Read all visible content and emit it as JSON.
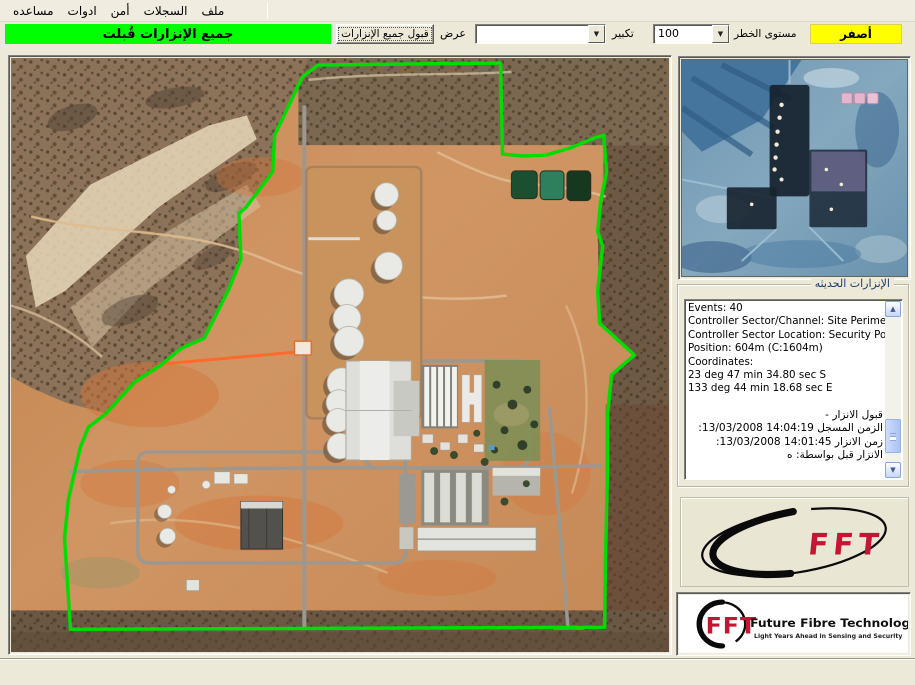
{
  "menu": {
    "items": [
      {
        "id": "help",
        "label": "مساعده"
      },
      {
        "id": "tools",
        "label": "ادوات"
      },
      {
        "id": "security",
        "label": "أمن"
      },
      {
        "id": "logs",
        "label": "السجلات"
      },
      {
        "id": "file",
        "label": "ملف"
      }
    ]
  },
  "toolbar": {
    "banner": {
      "text": "جميع الإنزارات قُبلت",
      "bg": "#00ff00"
    },
    "accept_all_label": "قبول جميع الإنزارات",
    "view_label": "عرض",
    "view_value": "",
    "zoom_label": "تكبير",
    "zoom_value": "100",
    "risk_label": "مستوى الخطر",
    "risk_value": "أصفر",
    "risk_bg": "#ffff00",
    "dropdown_arrow": "▼"
  },
  "events_panel": {
    "title": "الإنزارات الحديثه",
    "lines_en": [
      "Events: 40",
      "Controller Sector/Channel: Site Perimeter / 1",
      "Controller Sector Location: Security Post",
      "Position: 604m (C:1604m)",
      "Coordinates:",
      "23 deg 47 min 34.80 sec S",
      "133 deg 44 min 18.68 sec E"
    ],
    "lines_ar": [
      "قبول الانزار -",
      "الزمن المسجل 14:04:19 13/03/2008:",
      "زمن الانزار 14:01:45 13/03/2008:",
      "الانزار قبل بواسطة: ه"
    ],
    "scroll_up_glyph": "▲",
    "scroll_down_glyph": "▼"
  },
  "logos": {
    "fft_short": "FFT",
    "fft_company": "Future Fibre Technologies",
    "fft_tagline": "Light Years Ahead in Sensing and Security",
    "fft_red": "#c41532"
  },
  "colors": {
    "perimeter_green": "#00dd00",
    "alarm_orange": "#ff6a2a",
    "banner_green": "#00ff00",
    "risk_yellow": "#ffff00"
  }
}
